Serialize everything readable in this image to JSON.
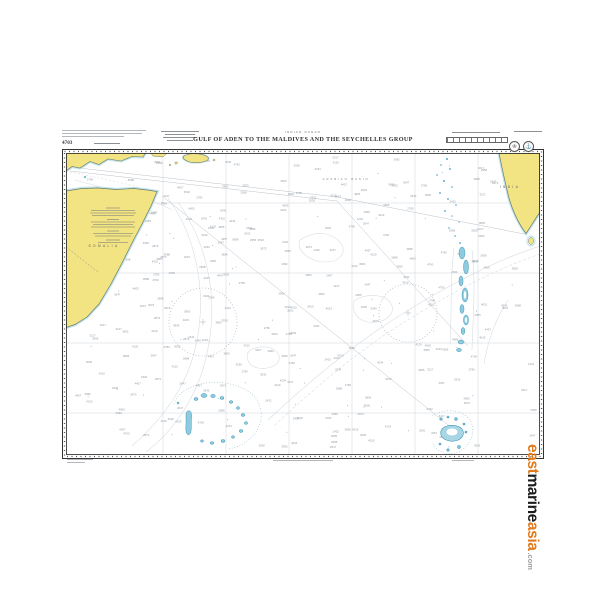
{
  "header": {
    "region": "INDIAN OCEAN",
    "title": "GULF OF ADEN TO THE MALDIVES AND THE SEYCHELLES GROUP",
    "chart_number": "4703",
    "emblems": [
      {
        "name": "crown-badge",
        "glyph": "♔"
      },
      {
        "name": "anchor-badge",
        "glyph": "⚓"
      }
    ]
  },
  "labels": {
    "land_left": "SOMALIA",
    "land_right": "INDIA",
    "sea_basin": "ARABIAN BASIN"
  },
  "watermark": {
    "word1": "east",
    "word2": "marine",
    "word3": "asia",
    "suffix": ".com"
  },
  "colors": {
    "land_yellow": "#f2e483",
    "shallow_edge": "#bfe3ec",
    "atoll_blue": "#8ecbdf",
    "atoll_outline": "#3f96b8",
    "frame": "#333333",
    "watermark_orange": "#e07b20"
  },
  "soundings": {
    "values": [
      "3712",
      "4234",
      "3960",
      "2873",
      "4457",
      "3340",
      "5102",
      "4015",
      "3688",
      "2432",
      "4790",
      "3217",
      "4521",
      "2958",
      "3805",
      "4120",
      "2647",
      "3530",
      "4873",
      "3092",
      "4310",
      "3955",
      "2780",
      "4605"
    ]
  }
}
